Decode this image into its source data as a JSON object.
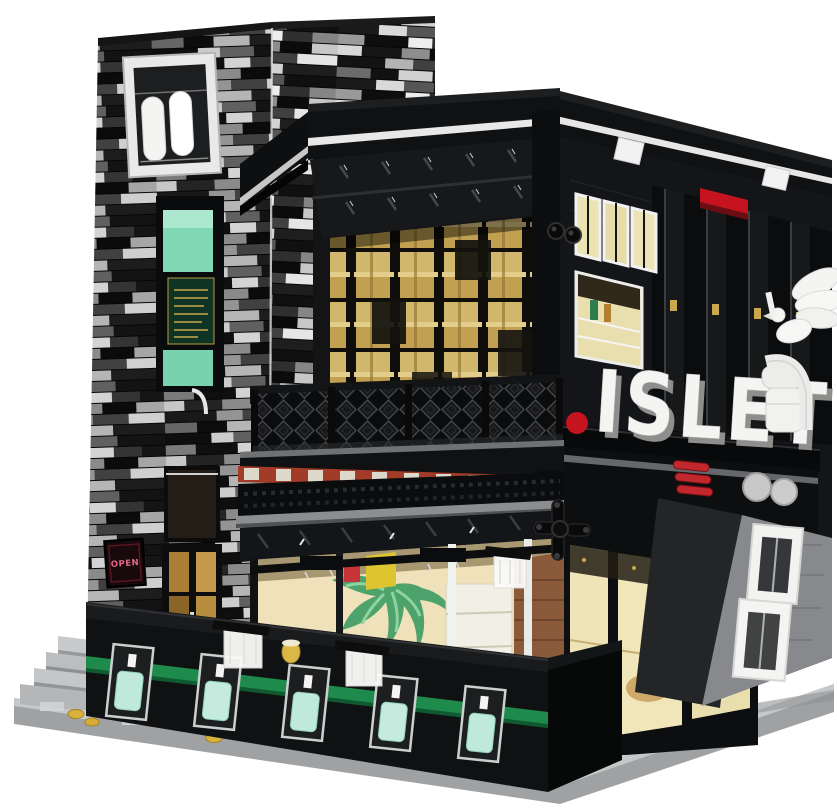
{
  "scene": {
    "description": "Product photo of a black-and-white brick modular building model: a two-storey bar/cafe named ISLET with a striped corner tower, gold upper windows, balcony lattice, lit ground-floor bar, outdoor terrace with bottle niches and a white dove statue",
    "background": "#ffffff"
  },
  "signs": {
    "main": "ISLET",
    "door": "OPEN"
  },
  "palette": {
    "brick_black": "#121315",
    "brick_white": "#f0f0ef",
    "brick_gray": "#9b9c9e",
    "glass_amber": "#c9a85c",
    "glass_teal": "#7fd7b4",
    "accent_red": "#c5141f",
    "stripe_green": "#1e8a4c",
    "base_gray": "#b4b5b7",
    "warm_interior": "#efe4bb",
    "statue_white": "#f3f3f1"
  }
}
